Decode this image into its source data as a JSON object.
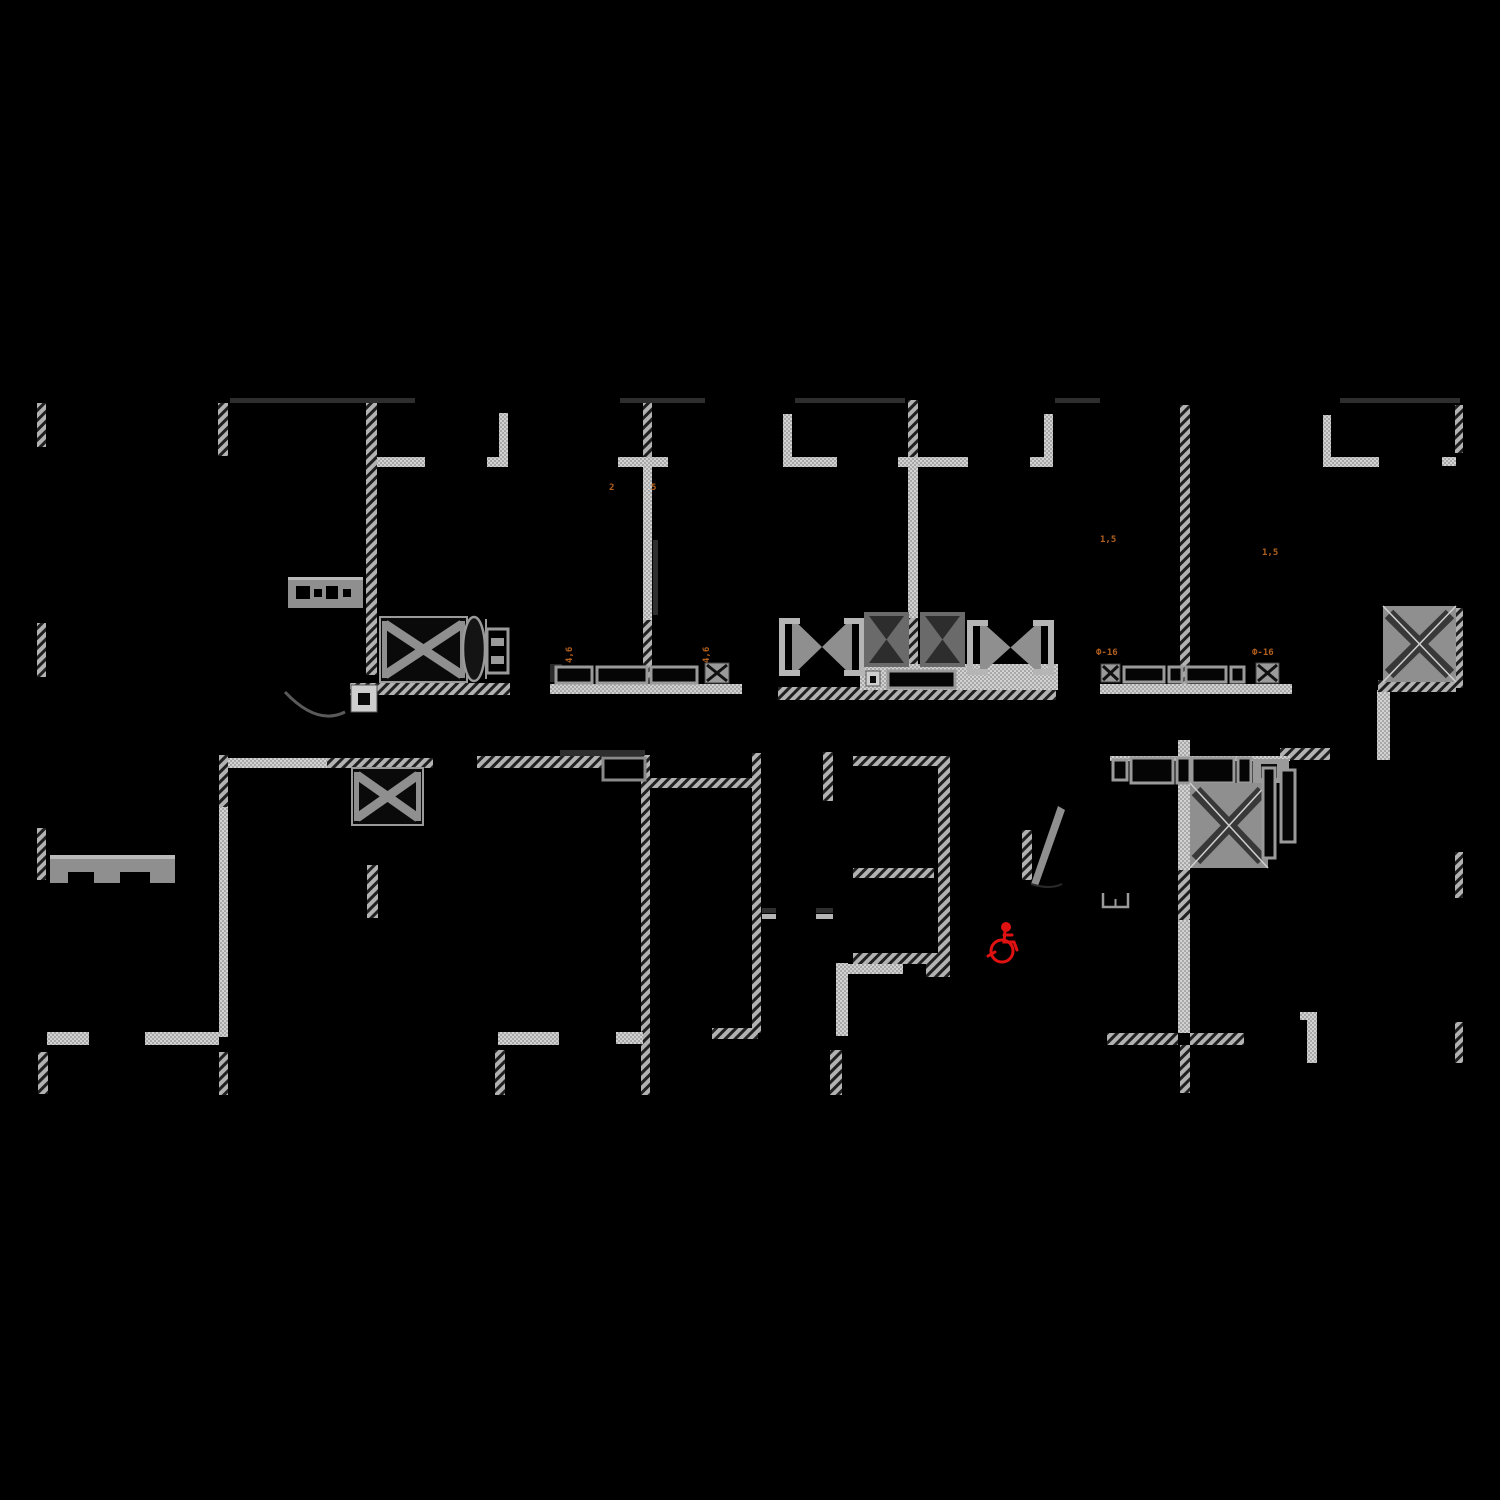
{
  "document": {
    "type": "architectural-floor-plan",
    "description": "CAD floor plan fragment on black background with hatched walls, shaft symbols, window bands and an accessibility mark",
    "background": "#000000"
  },
  "colors": {
    "background": "#000000",
    "wall_solid": "#c6c6c6",
    "wall_hatch_base": "#b2b2b2",
    "wall_hatch_stripe": "#1f1f1f",
    "fill_mid_gray": "#8f8f8f",
    "fill_dark_gray": "#2e2e2e",
    "accent_orange": "#b4611e",
    "accent_red": "#e01111"
  },
  "icons": [
    {
      "name": "wheelchair-accessible-icon",
      "color": "#e01111",
      "x": 983,
      "y": 914
    }
  ],
  "labels": [
    {
      "text": "2",
      "x": 609,
      "y": 483,
      "rot": 0
    },
    {
      "text": "5",
      "x": 651,
      "y": 483,
      "rot": 0
    },
    {
      "text": "4,6",
      "x": 565,
      "y": 663,
      "rot": 1
    },
    {
      "text": "4,6",
      "x": 702,
      "y": 663,
      "rot": 1
    },
    {
      "text": "1,5",
      "x": 1100,
      "y": 535,
      "rot": 0
    },
    {
      "text": "1,5",
      "x": 1262,
      "y": 548,
      "rot": 0
    },
    {
      "text": "Ф-16",
      "x": 1096,
      "y": 648,
      "rot": 0
    },
    {
      "text": "Ф-16",
      "x": 1252,
      "y": 648,
      "rot": 0
    }
  ],
  "plan": {
    "canvas": {
      "w": 1500,
      "h": 1500
    },
    "walls": [
      [
        37,
        403,
        9,
        44,
        "h"
      ],
      [
        218,
        403,
        10,
        53,
        "h"
      ],
      [
        366,
        403,
        11,
        272,
        "h"
      ],
      [
        377,
        457,
        48,
        10,
        "s"
      ],
      [
        499,
        413,
        9,
        48,
        "s"
      ],
      [
        487,
        457,
        21,
        10,
        "s"
      ],
      [
        643,
        400,
        9,
        57,
        "h"
      ],
      [
        643,
        457,
        9,
        163,
        "s"
      ],
      [
        643,
        620,
        9,
        60,
        "h"
      ],
      [
        618,
        457,
        50,
        10,
        "s"
      ],
      [
        783,
        414,
        9,
        48,
        "s"
      ],
      [
        783,
        457,
        54,
        10,
        "s"
      ],
      [
        908,
        400,
        10,
        57,
        "h"
      ],
      [
        908,
        457,
        10,
        161,
        "s"
      ],
      [
        908,
        618,
        10,
        64,
        "h"
      ],
      [
        898,
        457,
        70,
        10,
        "s"
      ],
      [
        1044,
        414,
        9,
        48,
        "s"
      ],
      [
        1030,
        457,
        23,
        10,
        "s"
      ],
      [
        1180,
        405,
        10,
        280,
        "h"
      ],
      [
        1323,
        415,
        8,
        47,
        "s"
      ],
      [
        1323,
        457,
        56,
        10,
        "s"
      ],
      [
        1455,
        405,
        8,
        48,
        "h"
      ],
      [
        1442,
        457,
        14,
        9,
        "s"
      ],
      [
        37,
        623,
        9,
        54,
        "h"
      ],
      [
        230,
        398,
        185,
        5,
        "d"
      ],
      [
        620,
        398,
        85,
        5,
        "d"
      ],
      [
        795,
        398,
        110,
        5,
        "d"
      ],
      [
        1055,
        398,
        45,
        5,
        "d"
      ],
      [
        1340,
        398,
        120,
        5,
        "d"
      ],
      [
        560,
        750,
        85,
        6,
        "d"
      ],
      [
        653,
        540,
        5,
        75,
        "d"
      ],
      [
        227,
        758,
        100,
        10,
        "s"
      ],
      [
        327,
        758,
        106,
        10,
        "h"
      ],
      [
        477,
        756,
        126,
        12,
        "h"
      ],
      [
        650,
        778,
        105,
        10,
        "h"
      ],
      [
        219,
        755,
        9,
        52,
        "h"
      ],
      [
        219,
        807,
        9,
        230,
        "s"
      ],
      [
        219,
        1052,
        9,
        43,
        "h"
      ],
      [
        37,
        828,
        9,
        52,
        "h"
      ],
      [
        367,
        865,
        11,
        53,
        "h"
      ],
      [
        47,
        1032,
        42,
        13,
        "s"
      ],
      [
        145,
        1032,
        74,
        13,
        "s"
      ],
      [
        38,
        1052,
        10,
        42,
        "h"
      ],
      [
        641,
        755,
        9,
        290,
        "h"
      ],
      [
        641,
        1045,
        9,
        50,
        "h"
      ],
      [
        752,
        753,
        9,
        280,
        "h"
      ],
      [
        712,
        1028,
        46,
        11,
        "h"
      ],
      [
        823,
        752,
        10,
        49,
        "h"
      ],
      [
        830,
        1050,
        12,
        45,
        "h"
      ],
      [
        853,
        756,
        88,
        10,
        "h"
      ],
      [
        938,
        756,
        12,
        221,
        "h"
      ],
      [
        853,
        868,
        81,
        10,
        "h"
      ],
      [
        853,
        953,
        86,
        11,
        "h"
      ],
      [
        926,
        964,
        20,
        13,
        "h"
      ],
      [
        836,
        963,
        12,
        73,
        "s"
      ],
      [
        845,
        964,
        58,
        10,
        "s"
      ],
      [
        498,
        1032,
        61,
        13,
        "s"
      ],
      [
        495,
        1050,
        10,
        45,
        "h"
      ],
      [
        616,
        1032,
        27,
        12,
        "s"
      ],
      [
        1178,
        740,
        12,
        130,
        "s"
      ],
      [
        1178,
        870,
        12,
        50,
        "h"
      ],
      [
        1178,
        920,
        12,
        113,
        "s"
      ],
      [
        1180,
        1045,
        10,
        48,
        "h"
      ],
      [
        1107,
        1033,
        71,
        12,
        "h"
      ],
      [
        1190,
        1033,
        54,
        12,
        "h"
      ],
      [
        1455,
        852,
        8,
        46,
        "h"
      ],
      [
        1455,
        1022,
        8,
        41,
        "h"
      ],
      [
        1307,
        1015,
        10,
        48,
        "s"
      ],
      [
        1300,
        1012,
        17,
        8,
        "s"
      ],
      [
        1280,
        748,
        50,
        12,
        "h"
      ],
      [
        1377,
        690,
        13,
        70,
        "s"
      ],
      [
        1378,
        680,
        78,
        12,
        "h"
      ],
      [
        1455,
        608,
        8,
        80,
        "h"
      ],
      [
        550,
        684,
        192,
        10,
        "s"
      ],
      [
        1100,
        684,
        192,
        10,
        "s"
      ],
      [
        350,
        683,
        160,
        12,
        "h"
      ],
      [
        778,
        687,
        278,
        13,
        "h"
      ],
      [
        860,
        664,
        198,
        26,
        "s"
      ],
      [
        1110,
        756,
        180,
        5,
        "s"
      ],
      [
        762,
        908,
        14,
        5,
        "d"
      ],
      [
        762,
        914,
        14,
        5,
        "m"
      ],
      [
        816,
        908,
        17,
        5,
        "d"
      ],
      [
        816,
        914,
        17,
        5,
        "m"
      ]
    ],
    "symbols": [
      {
        "t": "cre",
        "x": 288,
        "y": 577,
        "w": 75,
        "h": 31
      },
      {
        "t": "arc",
        "x": 283,
        "y": 690,
        "w": 62,
        "h": 28
      },
      {
        "t": "xbox_dark",
        "x": 380,
        "y": 617,
        "w": 87,
        "h": 65
      },
      {
        "t": "ellipse_door",
        "x": 462,
        "y": 616,
        "w": 24,
        "h": 66
      },
      {
        "t": "hbox",
        "x": 487,
        "y": 629,
        "w": 21,
        "h": 44
      },
      {
        "t": "hinge",
        "x": 351,
        "y": 685,
        "w": 26,
        "h": 27
      },
      {
        "t": "darkbox",
        "x": 550,
        "y": 664,
        "w": 12,
        "h": 18
      },
      {
        "t": "window",
        "x": 556,
        "y": 667,
        "w": 36,
        "h": 16
      },
      {
        "t": "window",
        "x": 597,
        "y": 667,
        "w": 50,
        "h": 16
      },
      {
        "t": "window",
        "x": 651,
        "y": 667,
        "w": 46,
        "h": 16
      },
      {
        "t": "smallx",
        "x": 705,
        "y": 663,
        "w": 24,
        "h": 20
      },
      {
        "t": "bowtie",
        "x": 780,
        "y": 618,
        "w": 84,
        "h": 58
      },
      {
        "t": "bowtie",
        "x": 968,
        "y": 620,
        "w": 85,
        "h": 55
      },
      {
        "t": "hourglass",
        "x": 864,
        "y": 612,
        "w": 45,
        "h": 55
      },
      {
        "t": "hourglass",
        "x": 920,
        "y": 612,
        "w": 45,
        "h": 55
      },
      {
        "t": "window",
        "x": 888,
        "y": 671,
        "w": 67,
        "h": 17
      },
      {
        "t": "hinge",
        "x": 866,
        "y": 671,
        "w": 14,
        "h": 15
      },
      {
        "t": "smallx",
        "x": 1101,
        "y": 664,
        "w": 19,
        "h": 18
      },
      {
        "t": "window",
        "x": 1124,
        "y": 667,
        "w": 40,
        "h": 15
      },
      {
        "t": "window",
        "x": 1169,
        "y": 667,
        "w": 13,
        "h": 15
      },
      {
        "t": "window",
        "x": 1186,
        "y": 667,
        "w": 40,
        "h": 15
      },
      {
        "t": "window",
        "x": 1231,
        "y": 667,
        "w": 13,
        "h": 15
      },
      {
        "t": "smallx",
        "x": 1256,
        "y": 663,
        "w": 23,
        "h": 20
      },
      {
        "t": "xbox_gray",
        "x": 1383,
        "y": 606,
        "w": 73,
        "h": 76
      },
      {
        "t": "niche",
        "x": 603,
        "y": 758,
        "w": 42,
        "h": 22
      },
      {
        "t": "xbox_dark",
        "x": 352,
        "y": 768,
        "w": 71,
        "h": 57
      },
      {
        "t": "window",
        "x": 1113,
        "y": 760,
        "w": 14,
        "h": 20
      },
      {
        "t": "window",
        "x": 1131,
        "y": 758,
        "w": 42,
        "h": 25
      },
      {
        "t": "window",
        "x": 1177,
        "y": 758,
        "w": 13,
        "h": 25
      },
      {
        "t": "window",
        "x": 1192,
        "y": 758,
        "w": 42,
        "h": 25
      },
      {
        "t": "window",
        "x": 1238,
        "y": 758,
        "w": 13,
        "h": 25
      },
      {
        "t": "endblock",
        "x": 1253,
        "y": 759,
        "w": 36,
        "h": 24
      },
      {
        "t": "xbox_gray",
        "x": 1190,
        "y": 783,
        "w": 78,
        "h": 85
      },
      {
        "t": "vwindow",
        "x": 1263,
        "y": 768,
        "w": 12,
        "h": 90
      },
      {
        "t": "vwindow",
        "x": 1281,
        "y": 770,
        "w": 14,
        "h": 72
      },
      {
        "t": "doorleaf",
        "x": 1022,
        "y": 806,
        "w": 48,
        "h": 84
      },
      {
        "t": "furn_open",
        "x": 1103,
        "y": 893,
        "w": 25,
        "h": 14
      },
      {
        "t": "bed",
        "x": 50,
        "y": 855,
        "w": 125,
        "h": 28
      }
    ]
  }
}
